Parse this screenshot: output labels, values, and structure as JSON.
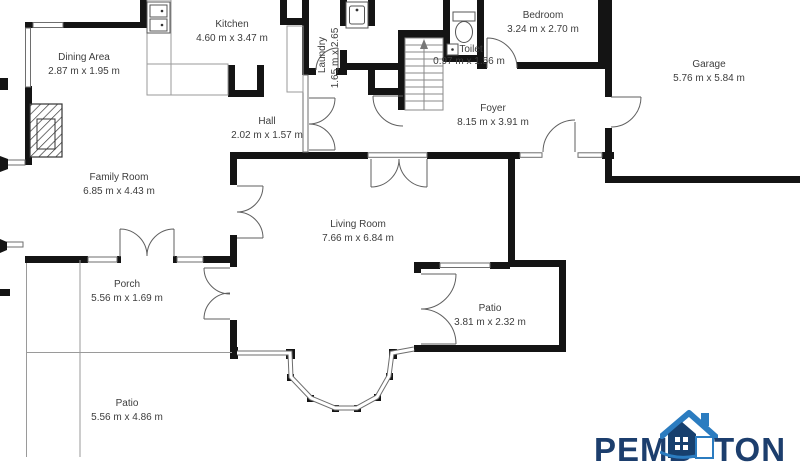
{
  "floorplan": {
    "rooms": [
      {
        "name": "Kitchen",
        "dims": "4.60 m x 3.47 m"
      },
      {
        "name": "Laundry",
        "dims": "1.65 m x 2.65"
      },
      {
        "name": "Bedroom",
        "dims": "3.24 m x 2.70 m"
      },
      {
        "name": "Toilet",
        "dims": "0.97 m x 1.56 m"
      },
      {
        "name": "Garage",
        "dims": "5.76 m x 5.84 m"
      },
      {
        "name": "Dining Area",
        "dims": "2.87 m x 1.95 m"
      },
      {
        "name": "Hall",
        "dims": "2.02 m x 1.57 m"
      },
      {
        "name": "Foyer",
        "dims": "8.15 m x 3.91 m"
      },
      {
        "name": "Family Room",
        "dims": "6.85 m x 4.43 m"
      },
      {
        "name": "Living Room",
        "dims": "7.66 m x 6.84 m"
      },
      {
        "name": "Porch",
        "dims": "5.56 m x 1.69 m"
      },
      {
        "name": "Patio",
        "dims": "3.81 m x 2.32 m"
      },
      {
        "name": "Patio",
        "dims": "5.56 m x 4.86 m"
      }
    ]
  },
  "branding": {
    "logo_left": "PEMB",
    "logo_right": "TON"
  },
  "colors": {
    "wall": "#141414",
    "label": "#3d3d3d",
    "logo_navy": "#1c3e6d",
    "logo_blue": "#2b7cc0"
  }
}
